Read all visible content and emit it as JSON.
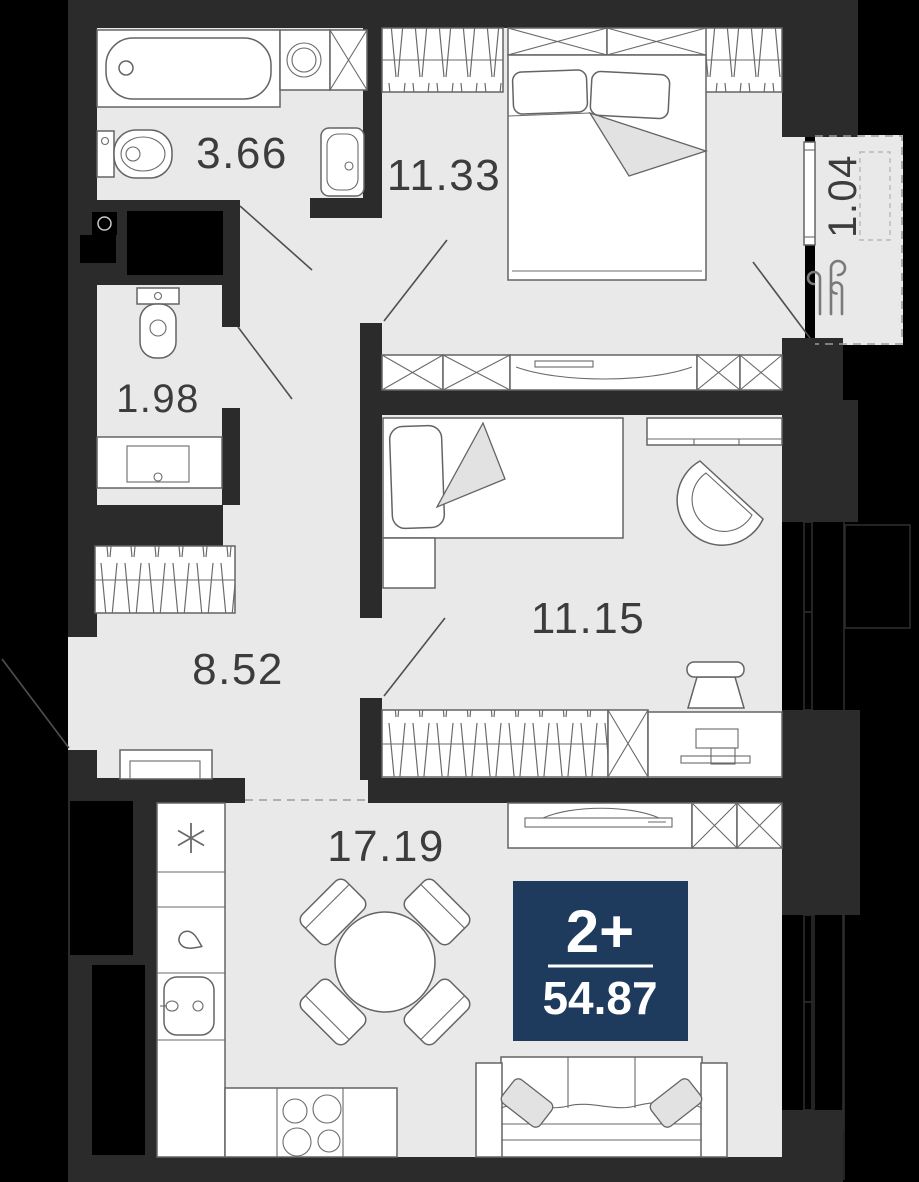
{
  "plan": {
    "unit": {
      "rooms_label": "2+",
      "total_area": "54.87"
    },
    "rooms": [
      {
        "id": "bathroom",
        "area_label": "3.66"
      },
      {
        "id": "bedroom",
        "area_label": "11.33"
      },
      {
        "id": "balcony",
        "area_label": "1.04"
      },
      {
        "id": "wc",
        "area_label": "1.98"
      },
      {
        "id": "hallway",
        "area_label": "8.52"
      },
      {
        "id": "kids-room",
        "area_label": "11.15"
      },
      {
        "id": "kitchen-living-room",
        "area_label": "17.19"
      }
    ],
    "colors": {
      "background": "#000000",
      "walls": "#2b2b2b",
      "floor": "#e9e9e9",
      "furniture_outline": "#646464",
      "badge_background": "#1e3a5c",
      "badge_text": "#ffffff",
      "label_text": "#3c3c3c"
    },
    "icons": [
      {
        "name": "snowflake-icon",
        "meaning": "refrigerator"
      },
      {
        "name": "drop-icon",
        "meaning": "water-tap"
      },
      {
        "name": "wind-icon",
        "meaning": "ventilation"
      }
    ]
  }
}
